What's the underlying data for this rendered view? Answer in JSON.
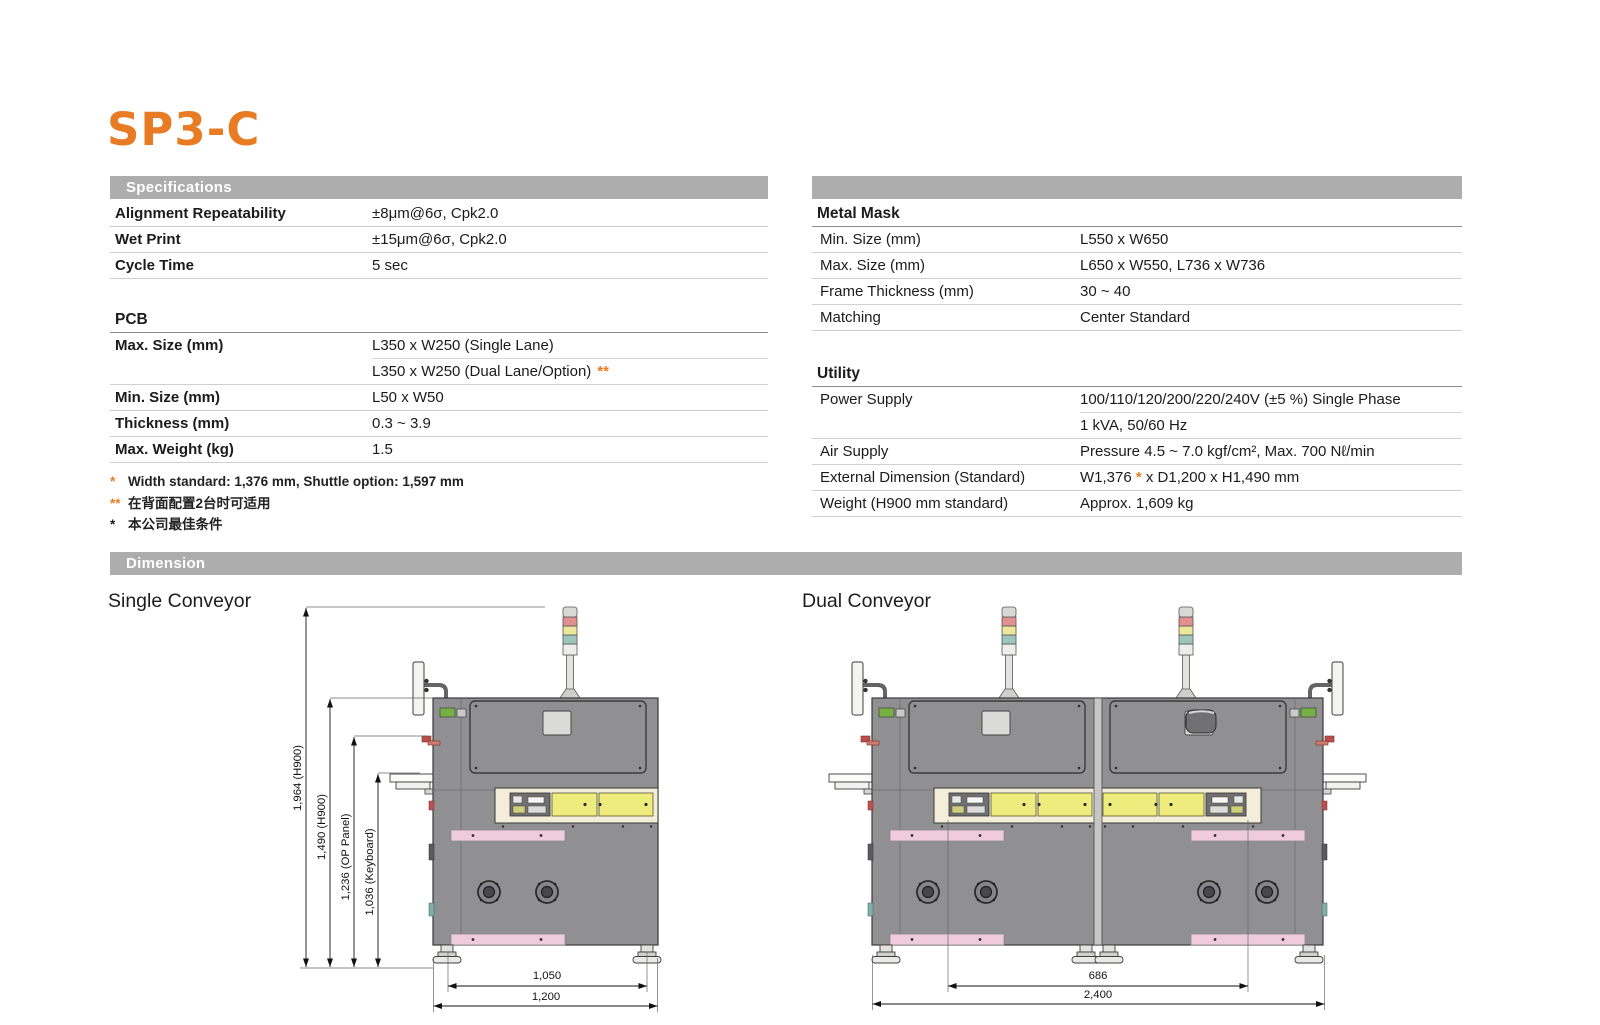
{
  "logo": "SP3-C",
  "bars": {
    "specifications": "Specifications",
    "dimension": "Dimension"
  },
  "spec_left": {
    "rows": [
      {
        "label": "Alignment Repeatability",
        "value": "±8μm@6σ, Cpk2.0"
      },
      {
        "label": "Wet Print",
        "value": "±15μm@6σ, Cpk2.0"
      },
      {
        "label": "Cycle Time",
        "value": "5 sec"
      }
    ],
    "pcb": {
      "heading": "PCB",
      "rows": [
        {
          "label": "Max. Size (mm)",
          "value": "L350 x W250 (Single Lane)",
          "marker": ""
        },
        {
          "label": "",
          "value": "L350 x W250 (Dual Lane/Option)",
          "marker": "**"
        },
        {
          "label": "Min. Size (mm)",
          "value": "L50 x W50",
          "marker": ""
        },
        {
          "label": "Thickness (mm)",
          "value": "0.3 ~ 3.9",
          "marker": ""
        },
        {
          "label": "Max. Weight (kg)",
          "value": "1.5",
          "marker": ""
        }
      ]
    },
    "footnotes": [
      {
        "marker": "*",
        "text": "Width standard: 1,376 mm, Shuttle option: 1,597 mm"
      },
      {
        "marker": "**",
        "text": "在背面配置2台时可适用"
      },
      {
        "marker": "*",
        "text": "本公司最佳条件"
      }
    ]
  },
  "spec_right": {
    "metal_mask": {
      "heading": "Metal Mask",
      "rows": [
        {
          "label": "Min. Size (mm)",
          "value": "L550 x W650"
        },
        {
          "label": "Max. Size (mm)",
          "value": "L650 x W550, L736 x W736"
        },
        {
          "label": "Frame Thickness (mm)",
          "value": "30 ~ 40"
        },
        {
          "label": "Matching",
          "value": "Center Standard"
        }
      ]
    },
    "utility": {
      "heading": "Utility",
      "rows": [
        {
          "label": "Power Supply",
          "value": "100/110/120/200/220/240V (±5 %) Single Phase"
        },
        {
          "label": "",
          "value": "1 kVA, 50/60 Hz"
        },
        {
          "label": "Air Supply",
          "value": "Pressure 4.5 ~ 7.0 kgf/cm², Max. 700 Nℓ/min"
        },
        {
          "label": "External Dimension (Standard)",
          "value_prefix": "W1,376 ",
          "marker": "*",
          "value_suffix": " x D1,200 x H1,490 mm"
        },
        {
          "label": "Weight (H900 mm standard)",
          "value": "Approx. 1,609 kg"
        }
      ]
    }
  },
  "dimension_section": {
    "single_label": "Single Conveyor",
    "dual_label": "Dual Conveyor",
    "single_dims": {
      "overall_height": "1,964 (H900)",
      "body_height": "1,490 (H900)",
      "op_panel_height": "1,236 (OP Panel)",
      "keyboard_height": "1,036 (Keyboard)",
      "feet_span": "1,050",
      "body_width": "1,200"
    },
    "dual_dims": {
      "inner_span": "686",
      "overall_width": "2,400"
    }
  },
  "colors": {
    "accent_orange": "#E87C25",
    "bar_gray": "#ADADAD",
    "machine_gray": "#909092",
    "panel_yellow": "#EFEC7E",
    "rail_pink": "#F0CBDD",
    "strip_cream": "#F3EDDA",
    "tower_red": "#E28F8F",
    "tower_yellow": "#EDE79B",
    "tower_teal": "#9CC6BB"
  }
}
